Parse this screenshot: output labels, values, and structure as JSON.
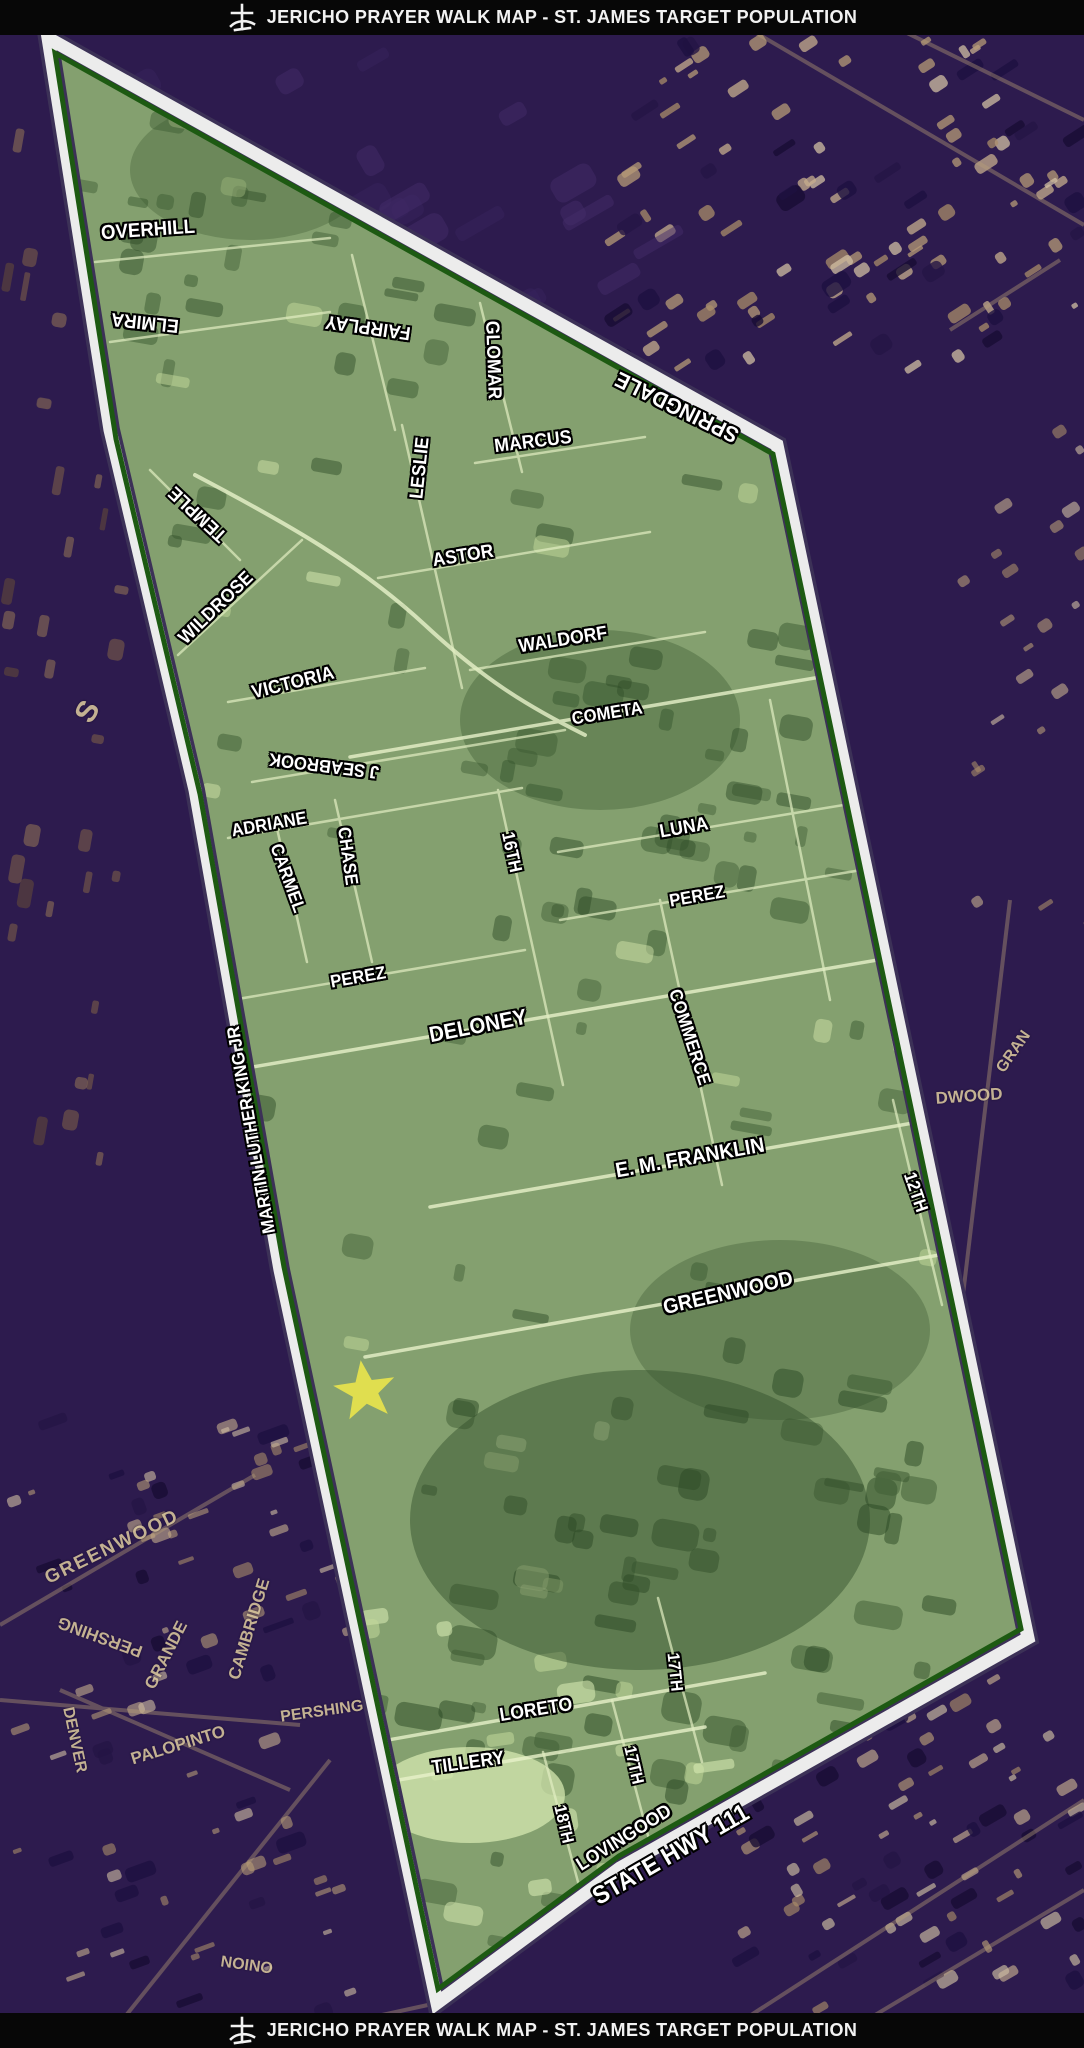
{
  "header": {
    "title": "JERICHO PRAYER WALK MAP - ST. JAMES TARGET POPULATION",
    "logo_icon": "cross-logo"
  },
  "footer": {
    "title": "JERICHO PRAYER WALK MAP - ST. JAMES TARGET POPULATION",
    "logo_icon": "cross-logo"
  },
  "map": {
    "description": "Aerial photo map; green highlighted target-area polygon outlined in white with dark-green edge; purple-toned aerial outside the area",
    "colors": {
      "bar_text": "#f2f2f2",
      "street_label": "#ffffff",
      "base_label": "#d9c69d",
      "boundary_white": "#ececec",
      "boundary_green": "#1d5a12",
      "boundary_shadow": "#3c3157",
      "region_green": "#84a06f",
      "outside_purple": "#2d1b4e",
      "star_yellow": "#e8e34c"
    },
    "marker": {
      "shape": "star",
      "x": 365,
      "y": 1391,
      "rotation": -8,
      "size": 62,
      "color": "#e8e34c"
    },
    "street_labels": [
      {
        "text": "OVERHILL",
        "x": 148,
        "y": 230,
        "rot": -4,
        "size": 20
      },
      {
        "text": "ELMIRA",
        "x": 145,
        "y": 322,
        "rot": 186,
        "size": 19
      },
      {
        "text": "FAIRPLAY",
        "x": 368,
        "y": 327,
        "rot": 188,
        "size": 19
      },
      {
        "text": "TEMPLE",
        "x": 198,
        "y": 514,
        "rot": 223,
        "size": 19
      },
      {
        "text": "GLOMAR",
        "x": 493,
        "y": 360,
        "rot": 88,
        "size": 19
      },
      {
        "text": "LESLIE",
        "x": 420,
        "y": 468,
        "rot": -84,
        "size": 19
      },
      {
        "text": "MARCUS",
        "x": 533,
        "y": 442,
        "rot": -7,
        "size": 19
      },
      {
        "text": "SPRINGDALE",
        "x": 677,
        "y": 407,
        "rot": 206,
        "size": 22
      },
      {
        "text": "ASTOR",
        "x": 463,
        "y": 556,
        "rot": -9,
        "size": 19
      },
      {
        "text": "WILDROSE",
        "x": 216,
        "y": 608,
        "rot": -44,
        "size": 19
      },
      {
        "text": "WALDORF",
        "x": 563,
        "y": 640,
        "rot": -9,
        "size": 19
      },
      {
        "text": "VICTORIA",
        "x": 293,
        "y": 683,
        "rot": -14,
        "size": 19
      },
      {
        "text": "COMETA",
        "x": 607,
        "y": 713,
        "rot": -9,
        "size": 18
      },
      {
        "text": "J SEABROOK",
        "x": 324,
        "y": 766,
        "rot": 187,
        "size": 18
      },
      {
        "text": "ADRIANE",
        "x": 269,
        "y": 824,
        "rot": -10,
        "size": 18
      },
      {
        "text": "LUNA",
        "x": 684,
        "y": 828,
        "rot": -10,
        "size": 19
      },
      {
        "text": "CARMEL",
        "x": 288,
        "y": 878,
        "rot": 70,
        "size": 18
      },
      {
        "text": "CHASE",
        "x": 348,
        "y": 856,
        "rot": 82,
        "size": 18
      },
      {
        "text": "16TH",
        "x": 512,
        "y": 852,
        "rot": 78,
        "size": 18
      },
      {
        "text": "PEREZ",
        "x": 697,
        "y": 896,
        "rot": -10,
        "size": 18
      },
      {
        "text": "PEREZ",
        "x": 358,
        "y": 977,
        "rot": -10,
        "size": 18
      },
      {
        "text": "DELONEY",
        "x": 478,
        "y": 1026,
        "rot": -11,
        "size": 22
      },
      {
        "text": "COMMERCE",
        "x": 690,
        "y": 1037,
        "rot": 72,
        "size": 18
      },
      {
        "text": "MARTIN LUTHER KING JR",
        "x": 251,
        "y": 1130,
        "rot": -100,
        "size": 18
      },
      {
        "text": "E. M. FRANKLIN",
        "x": 690,
        "y": 1158,
        "rot": -10,
        "size": 21
      },
      {
        "text": "12TH",
        "x": 916,
        "y": 1192,
        "rot": 71,
        "size": 18
      },
      {
        "text": "GREENWOOD",
        "x": 728,
        "y": 1293,
        "rot": -13,
        "size": 21
      },
      {
        "text": "LORETO",
        "x": 536,
        "y": 1710,
        "rot": -9,
        "size": 19
      },
      {
        "text": "17TH",
        "x": 675,
        "y": 1672,
        "rot": 84,
        "size": 17
      },
      {
        "text": "17TH",
        "x": 634,
        "y": 1765,
        "rot": 77,
        "size": 17
      },
      {
        "text": "TILLERY",
        "x": 468,
        "y": 1763,
        "rot": -8,
        "size": 19
      },
      {
        "text": "18TH",
        "x": 564,
        "y": 1824,
        "rot": 77,
        "size": 17
      },
      {
        "text": "LOVINGOOD",
        "x": 624,
        "y": 1838,
        "rot": -32,
        "size": 19
      },
      {
        "text": "STATE HWY 111",
        "x": 671,
        "y": 1855,
        "rot": -30,
        "size": 25
      }
    ],
    "base_labels": [
      {
        "text": "S",
        "x": 88,
        "y": 712,
        "rot": -60,
        "size": 30
      },
      {
        "text": "DWOOD",
        "x": 969,
        "y": 1096,
        "rot": -4,
        "size": 17
      },
      {
        "text": "GRAN",
        "x": 1014,
        "y": 1052,
        "rot": -55,
        "size": 16
      },
      {
        "text": "GREENWOOD",
        "x": 112,
        "y": 1547,
        "rot": -26,
        "size": 19,
        "spacing": 2
      },
      {
        "text": "PERSHING",
        "x": 100,
        "y": 1637,
        "rot": 200,
        "size": 17
      },
      {
        "text": "GRANDE",
        "x": 166,
        "y": 1655,
        "rot": -63,
        "size": 17
      },
      {
        "text": "CAMBRIDGE",
        "x": 249,
        "y": 1629,
        "rot": -73,
        "size": 17
      },
      {
        "text": "DENVER",
        "x": 74,
        "y": 1740,
        "rot": 78,
        "size": 16
      },
      {
        "text": "PALOPINTO",
        "x": 178,
        "y": 1745,
        "rot": -17,
        "size": 17
      },
      {
        "text": "PERSHING",
        "x": 322,
        "y": 1712,
        "rot": -8,
        "size": 16
      },
      {
        "text": "ONION",
        "x": 247,
        "y": 1963,
        "rot": 188,
        "size": 16
      }
    ]
  }
}
